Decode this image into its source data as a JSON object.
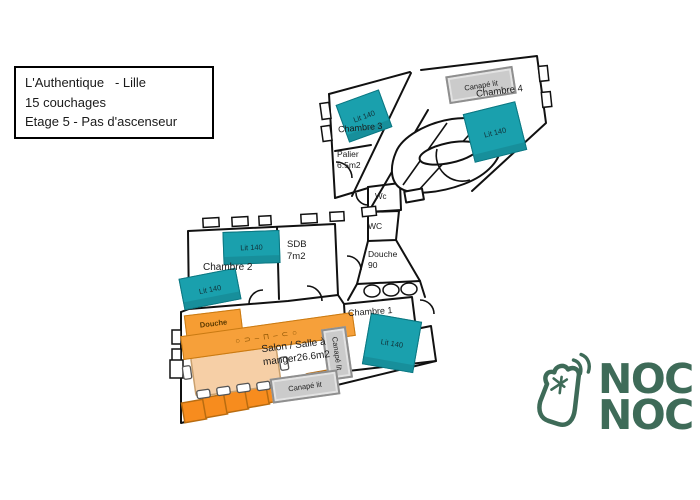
{
  "info_box": {
    "line1": "L'Authentique   - Lille",
    "line2": "15 couchages",
    "line3": "Etage 5 - Pas d'ascenseur"
  },
  "rooms": {
    "chambre3": "Chambre 3",
    "chambre4": "Chambre 4",
    "palier_name": "Palier",
    "palier_area": "6.5m2",
    "wc_small": "Wc",
    "wc_large": "WC",
    "douche_name": "Douche",
    "douche_size": "90",
    "chambre2": "Chambre 2",
    "sdb_name": "SDB",
    "sdb_area": "7m2",
    "salon_line1": "Salon / Salle à",
    "salon_line2": "manger26.6m2",
    "chambre1": "Chambre 1"
  },
  "furniture": {
    "bed_label": "Lit 140",
    "sofa_label": "Canapé lit",
    "shower_label": "Douche",
    "kitchen_icons": "○⊃‒⊓‒⊂○"
  },
  "logo": {
    "line1": "NOC",
    "line2": "NOC"
  },
  "colors": {
    "bed_teal": "#1aa0ad",
    "cabinet_orange": "#f78c1e",
    "counter_orange": "#f6a03a",
    "table_peach": "#f6cfa6",
    "sofa_gray": "#cbcbcb",
    "logo_green": "#3e6b58",
    "wall_black": "#111111"
  }
}
